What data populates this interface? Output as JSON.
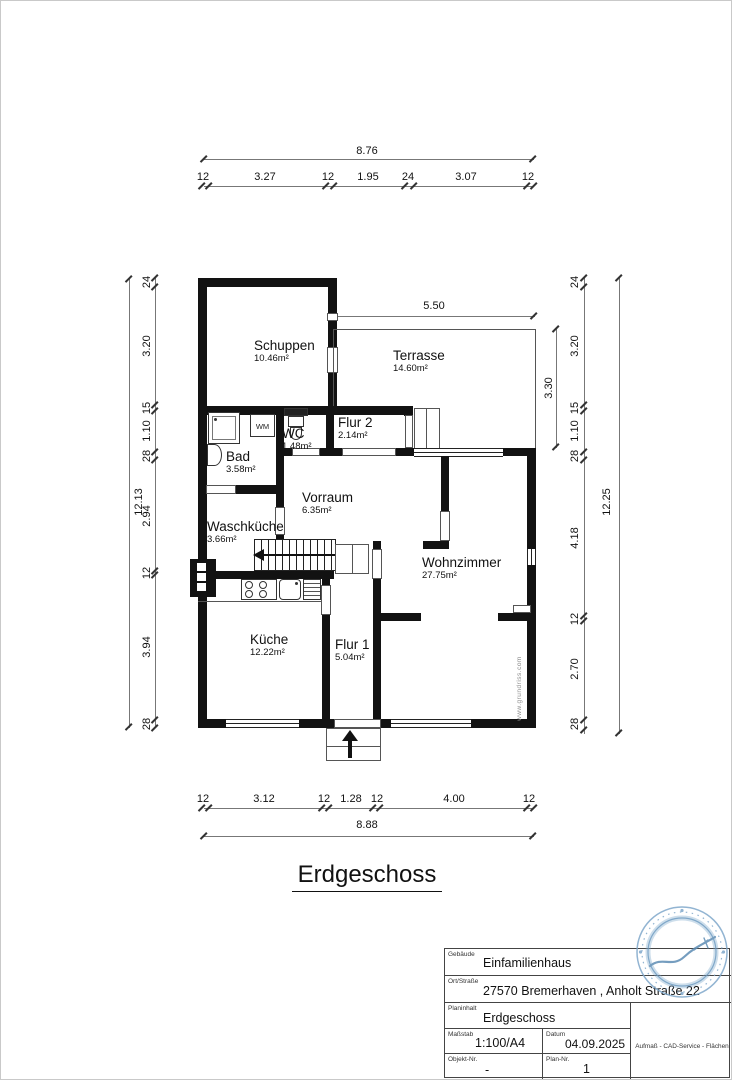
{
  "sheet": {
    "title": "Erdgeschoss"
  },
  "rooms": [
    {
      "name": "Schuppen",
      "area": "10.46m²"
    },
    {
      "name": "Terrasse",
      "area": "14.60m²"
    },
    {
      "name": "WC",
      "area": "1.48m²"
    },
    {
      "name": "Flur 2",
      "area": "2.14m²"
    },
    {
      "name": "Bad",
      "area": "3.58m²"
    },
    {
      "name": "Vorraum",
      "area": "6.35m²"
    },
    {
      "name": "Waschküche",
      "area": "3.66m²"
    },
    {
      "name": "Wohnzimmer",
      "area": "27.75m²"
    },
    {
      "name": "Küche",
      "area": "12.22m²"
    },
    {
      "name": "Flur 1",
      "area": "5.04m²"
    }
  ],
  "fixtures": {
    "washing_machine": "WM"
  },
  "dims": {
    "top": {
      "total": "8.76",
      "segments": [
        "12",
        "3.27",
        "12",
        "1.95",
        "24",
        "3.07",
        "12"
      ]
    },
    "bottom": {
      "total": "8.88",
      "segments": [
        "12",
        "3.12",
        "12",
        "1.28",
        "12",
        "4.00",
        "12"
      ]
    },
    "left": {
      "total": "12.13",
      "segments": [
        "24",
        "3.20",
        "15",
        "1.10",
        "28",
        "2.94",
        "12",
        "3.94",
        "28"
      ]
    },
    "right": {
      "total": "12.25",
      "segments": [
        "24",
        "3.20",
        "15",
        "1.10",
        "28",
        "4.18",
        "12",
        "2.70",
        "28"
      ]
    },
    "terrace_width": "5.50",
    "terrace_depth": "3.30"
  },
  "watermark": "www.grundriss.com",
  "titleblock": {
    "fields": [
      {
        "label": "Gebäude",
        "value": "Einfamilienhaus"
      },
      {
        "label": "Ort/Straße",
        "value": "27570 Bremerhaven , Anholt Straße 22"
      },
      {
        "label": "Planinhalt",
        "value": "Erdgeschoss"
      },
      {
        "label": "Maßstab",
        "value": "1:100/A4"
      },
      {
        "label": "Datum",
        "value": "04.09.2025"
      },
      {
        "label": "Objekt-Nr.",
        "value": "-"
      },
      {
        "label": "Plan-Nr.",
        "value": "1"
      }
    ],
    "company": "Aufmaß - CAD-Service - Flächen"
  },
  "stamp": {
    "color": "#7fa8cb"
  }
}
